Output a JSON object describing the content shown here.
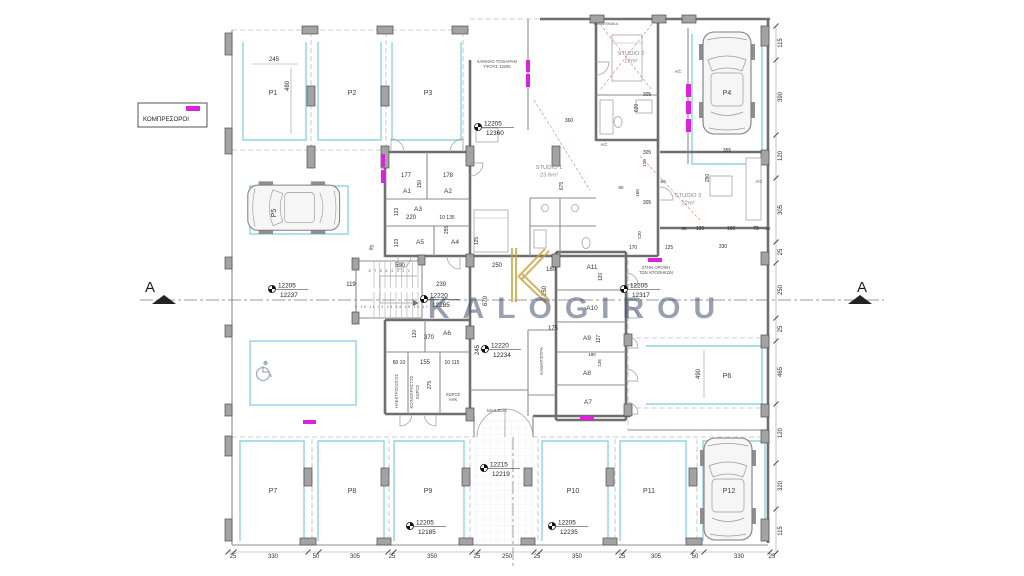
{
  "watermark": {
    "text": "KALOGIROU",
    "logo_letter": "K",
    "color": "#47536e",
    "logo_gold": "#c8a23e"
  },
  "legend": {
    "label": "ΚΟΜΠΡΕΣΟΡΟΙ",
    "swatch_color": "#dd22dd"
  },
  "section_markers": {
    "left": "A",
    "right": "A"
  },
  "stairs": {
    "run1": "8 7 6 5 4 3 2 1",
    "run2": "9 10 11 12 13 14 15 16 17"
  },
  "colors": {
    "compressor_magenta": "#dd22dd",
    "parking_bay_blue": "#8fd2e4",
    "wall_gray": "#6f6f6f",
    "red_dashed": "#cc3333"
  },
  "icons": {
    "wheelchair": "accessible-parking-symbol",
    "benchmark": "survey-level-marker"
  },
  "parking_spaces": [
    {
      "id": "P1",
      "x": 273,
      "y": 95
    },
    {
      "id": "P2",
      "x": 352,
      "y": 95
    },
    {
      "id": "P3",
      "x": 428,
      "y": 95
    },
    {
      "id": "P4",
      "x": 727,
      "y": 95
    },
    {
      "id": "P5",
      "x": 276,
      "y": 213,
      "r": -90
    },
    {
      "id": "P6",
      "x": 727,
      "y": 378
    },
    {
      "id": "P7",
      "x": 273,
      "y": 493
    },
    {
      "id": "P8",
      "x": 352,
      "y": 493
    },
    {
      "id": "P9",
      "x": 428,
      "y": 493
    },
    {
      "id": "P10",
      "x": 573,
      "y": 493
    },
    {
      "id": "P11",
      "x": 649,
      "y": 493
    },
    {
      "id": "P12",
      "x": 729,
      "y": 493
    }
  ],
  "storage_rooms": [
    {
      "id": "A1",
      "x": 407,
      "y": 193
    },
    {
      "id": "A2",
      "x": 448,
      "y": 193
    },
    {
      "id": "A3",
      "x": 418,
      "y": 211
    },
    {
      "id": "A4",
      "x": 455,
      "y": 244
    },
    {
      "id": "A5",
      "x": 420,
      "y": 244
    },
    {
      "id": "A6",
      "x": 447,
      "y": 335
    },
    {
      "id": "A7",
      "x": 588,
      "y": 404
    },
    {
      "id": "A8",
      "x": 587,
      "y": 375
    },
    {
      "id": "A9",
      "x": 587,
      "y": 340
    },
    {
      "id": "A10",
      "x": 592,
      "y": 310
    },
    {
      "id": "A11",
      "x": 592,
      "y": 269
    }
  ],
  "studios": [
    {
      "name": "STUDIO 1",
      "area": "23.6m²",
      "x": 549,
      "y": 169
    },
    {
      "name": "STUDIO 2",
      "area": "22m²",
      "x": 631,
      "y": 55
    },
    {
      "name": "STUDIO 3",
      "area": "22m²",
      "x": 688,
      "y": 197
    }
  ],
  "annotations": [
    {
      "t": "ΧΑΜΗΛΟ ΤΟΙΧΑΡΑΚΙ",
      "x": 497,
      "y": 63
    },
    {
      "t": "ΥΨΟΥΣ 1150Κ",
      "x": 497,
      "y": 68
    },
    {
      "t": "ΚΟΙΤΑ ΠΙΝΑΚΑ",
      "x": 606,
      "y": 25,
      "s": 3.5
    },
    {
      "t": "ΣΤΗΝ ΟΡΟΦΗ",
      "x": 656,
      "y": 269
    },
    {
      "t": "ΤΩΝ ΑΠΟΘΗΚΩΝ",
      "x": 656,
      "y": 274
    },
    {
      "t": "A/C",
      "x": 678,
      "y": 73
    },
    {
      "t": "A/C",
      "x": 604,
      "y": 146
    },
    {
      "t": "A/C",
      "x": 759,
      "y": 183
    },
    {
      "t": "ΗΛΕΚΤΡΟΛΟΓΟΣ",
      "x": 398,
      "y": 391,
      "r": -90
    },
    {
      "t": "ΚΟΙΝΟΧΡΗΣΤΟΣ",
      "x": 413,
      "y": 392,
      "r": -90
    },
    {
      "t": "ΧΩΡΟΣ",
      "x": 419,
      "y": 392,
      "r": -90
    },
    {
      "t": "ΧΩΡΟΣ",
      "x": 453,
      "y": 396
    },
    {
      "t": "ΑΗΚ",
      "x": 453,
      "y": 401
    },
    {
      "t": "MAILBOX",
      "x": 497,
      "y": 412,
      "s": 4.5
    },
    {
      "t": "ΚΑΘΑΡΙΣΤΡΑ",
      "x": 543,
      "y": 361,
      "r": -90,
      "s": 4.5
    }
  ],
  "elevation_markers": [
    {
      "above": "12205",
      "below": "12360",
      "x": 478,
      "y": 127
    },
    {
      "above": "12205",
      "below": "12237",
      "x": 272,
      "y": 289
    },
    {
      "above": "12205",
      "below": "12317",
      "x": 624,
      "y": 289
    },
    {
      "above": "12220",
      "below": "12285",
      "x": 424,
      "y": 299
    },
    {
      "above": "12220",
      "below": "12234",
      "x": 485,
      "y": 349
    },
    {
      "above": "12215",
      "below": "12219",
      "x": 484,
      "y": 468
    },
    {
      "above": "12205",
      "below": "12185",
      "x": 410,
      "y": 526
    },
    {
      "above": "12205",
      "below": "12235",
      "x": 552,
      "y": 526
    }
  ],
  "dimensions": {
    "inner": [
      {
        "t": "245",
        "x": 274,
        "y": 61
      },
      {
        "t": "480",
        "x": 289,
        "y": 86,
        "r": -90
      },
      {
        "t": "177",
        "x": 406,
        "y": 177
      },
      {
        "t": "178",
        "x": 448,
        "y": 177
      },
      {
        "t": "150",
        "x": 421,
        "y": 184,
        "r": -90,
        "s": 5
      },
      {
        "t": "123",
        "x": 398,
        "y": 212,
        "r": -90,
        "s": 5
      },
      {
        "t": "220",
        "x": 411,
        "y": 219
      },
      {
        "t": "10 135",
        "x": 447,
        "y": 219,
        "s": 5
      },
      {
        "t": "255",
        "x": 448,
        "y": 230,
        "r": -90,
        "s": 5
      },
      {
        "t": "123",
        "x": 398,
        "y": 243,
        "r": -90,
        "s": 5
      },
      {
        "t": "125",
        "x": 478,
        "y": 241,
        "r": -90,
        "s": 5
      },
      {
        "t": "85",
        "x": 373,
        "y": 248,
        "r": -70,
        "s": 5
      },
      {
        "t": "590",
        "x": 400,
        "y": 267
      },
      {
        "t": "119",
        "x": 351,
        "y": 286
      },
      {
        "t": "239",
        "x": 441,
        "y": 286
      },
      {
        "t": "250",
        "x": 497,
        "y": 267
      },
      {
        "t": "670",
        "x": 487,
        "y": 301,
        "r": -90
      },
      {
        "t": "180",
        "x": 551,
        "y": 271
      },
      {
        "t": "250",
        "x": 546,
        "y": 291,
        "r": -90
      },
      {
        "t": "675",
        "x": 563,
        "y": 186,
        "r": -90,
        "s": 5
      },
      {
        "t": "120",
        "x": 416,
        "y": 334,
        "r": -90,
        "s": 5
      },
      {
        "t": "370",
        "x": 429,
        "y": 339
      },
      {
        "t": "245",
        "x": 479,
        "y": 350,
        "r": -90
      },
      {
        "t": "80 10",
        "x": 399,
        "y": 364,
        "s": 5
      },
      {
        "t": "155",
        "x": 425,
        "y": 364
      },
      {
        "t": "10 115",
        "x": 452,
        "y": 364,
        "s": 5
      },
      {
        "t": "275",
        "x": 431,
        "y": 385,
        "r": -90,
        "s": 5
      },
      {
        "t": "175",
        "x": 553,
        "y": 330
      },
      {
        "t": "120",
        "x": 602,
        "y": 277,
        "r": -90,
        "s": 5
      },
      {
        "t": "127",
        "x": 600,
        "y": 339,
        "r": -90,
        "s": 5
      },
      {
        "t": "180",
        "x": 592,
        "y": 356,
        "s": 4.5
      },
      {
        "t": "126",
        "x": 601,
        "y": 363,
        "r": -90,
        "s": 4.5
      },
      {
        "t": "360",
        "x": 569,
        "y": 122,
        "s": 5
      },
      {
        "t": "305",
        "x": 647,
        "y": 96,
        "s": 5
      },
      {
        "t": "620",
        "x": 638,
        "y": 108,
        "r": -90,
        "s": 5
      },
      {
        "t": "305",
        "x": 647,
        "y": 154,
        "s": 5
      },
      {
        "t": "120",
        "x": 646,
        "y": 163,
        "r": -90,
        "s": 4.5
      },
      {
        "t": "355",
        "x": 727,
        "y": 152,
        "s": 5
      },
      {
        "t": "290",
        "x": 709,
        "y": 178,
        "r": -90,
        "s": 5
      },
      {
        "t": "305",
        "x": 647,
        "y": 204,
        "s": 5
      },
      {
        "t": "160",
        "x": 639,
        "y": 193,
        "r": -90,
        "s": 4.5
      },
      {
        "t": "60",
        "x": 621,
        "y": 189,
        "s": 4.5
      },
      {
        "t": "60",
        "x": 663,
        "y": 183,
        "s": 4.5
      },
      {
        "t": "170",
        "x": 633,
        "y": 249,
        "s": 5
      },
      {
        "t": "125",
        "x": 669,
        "y": 249,
        "s": 5
      },
      {
        "t": "120",
        "x": 641,
        "y": 235,
        "r": -90,
        "s": 4.5
      },
      {
        "t": "25",
        "x": 684,
        "y": 230,
        "s": 4.5
      },
      {
        "t": "120",
        "x": 700,
        "y": 230,
        "s": 5
      },
      {
        "t": "160",
        "x": 731,
        "y": 230,
        "s": 5
      },
      {
        "t": "75",
        "x": 756,
        "y": 230,
        "s": 5
      },
      {
        "t": "25",
        "x": 768,
        "y": 230,
        "s": 4.5
      },
      {
        "t": "330",
        "x": 723,
        "y": 248,
        "s": 5
      },
      {
        "t": "490",
        "x": 700,
        "y": 374,
        "r": -90
      }
    ],
    "bottom_chain_y": 558,
    "bottom_chain": [
      {
        "t": "25",
        "x": 233
      },
      {
        "t": "330",
        "x": 273
      },
      {
        "t": "50",
        "x": 316
      },
      {
        "t": "305",
        "x": 355
      },
      {
        "t": "25",
        "x": 392
      },
      {
        "t": "350",
        "x": 432
      },
      {
        "t": "25",
        "x": 477
      },
      {
        "t": "250",
        "x": 507
      },
      {
        "t": "25",
        "x": 537
      },
      {
        "t": "350",
        "x": 577
      },
      {
        "t": "25",
        "x": 622
      },
      {
        "t": "305",
        "x": 656
      },
      {
        "t": "50",
        "x": 695
      },
      {
        "t": "330",
        "x": 739
      },
      {
        "t": "25",
        "x": 772
      }
    ],
    "right_chain_x": 782,
    "right_chain": [
      {
        "t": "115",
        "y": 43
      },
      {
        "t": "390",
        "y": 97
      },
      {
        "t": "120",
        "y": 156
      },
      {
        "t": "305",
        "y": 210
      },
      {
        "t": "25",
        "y": 252
      },
      {
        "t": "250",
        "y": 290
      },
      {
        "t": "25",
        "y": 329
      },
      {
        "t": "465",
        "y": 372
      },
      {
        "t": "120",
        "y": 433
      },
      {
        "t": "320",
        "y": 486
      },
      {
        "t": "115",
        "y": 531
      }
    ]
  }
}
